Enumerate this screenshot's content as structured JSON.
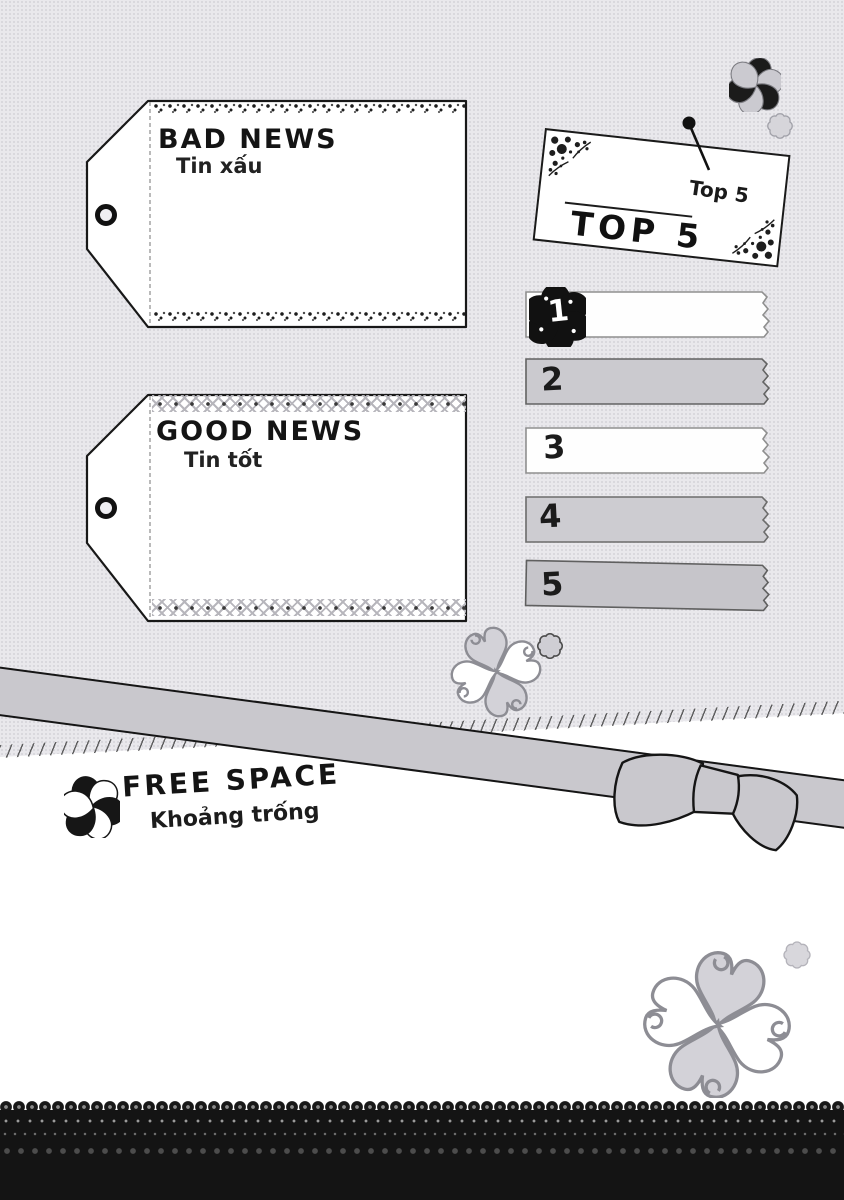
{
  "tags": {
    "bad_news": {
      "title": "BAD NEWS",
      "subtitle": "Tin xấu"
    },
    "good_news": {
      "title": "GOOD NEWS",
      "subtitle": "Tin tốt"
    }
  },
  "top5_card": {
    "note_label": "Top 5",
    "title": "TOP 5"
  },
  "ranking": {
    "items": [
      {
        "rank": "1"
      },
      {
        "rank": "2"
      },
      {
        "rank": "3"
      },
      {
        "rank": "4"
      },
      {
        "rank": "5"
      }
    ]
  },
  "free_space": {
    "title": "FREE SPACE",
    "subtitle": "Khoảng trống"
  },
  "icons": {
    "rank_one_badge": "clover-flower-icon",
    "header_markers": "clover-icon",
    "pin": "push-pin-icon",
    "ribbon": "ribbon-bow",
    "decorations": [
      "heart-clover-icon",
      "scalloped-flower-icon"
    ],
    "bottom_edge": "lace-trim"
  },
  "colors": {
    "page_gray": "#e9e8ec",
    "paper_white": "#ffffff",
    "strip_gray": "#cbcacf",
    "ribbon_gray": "#c9c8cd",
    "ink": "#1a1a1a",
    "lace_black": "#141414"
  }
}
